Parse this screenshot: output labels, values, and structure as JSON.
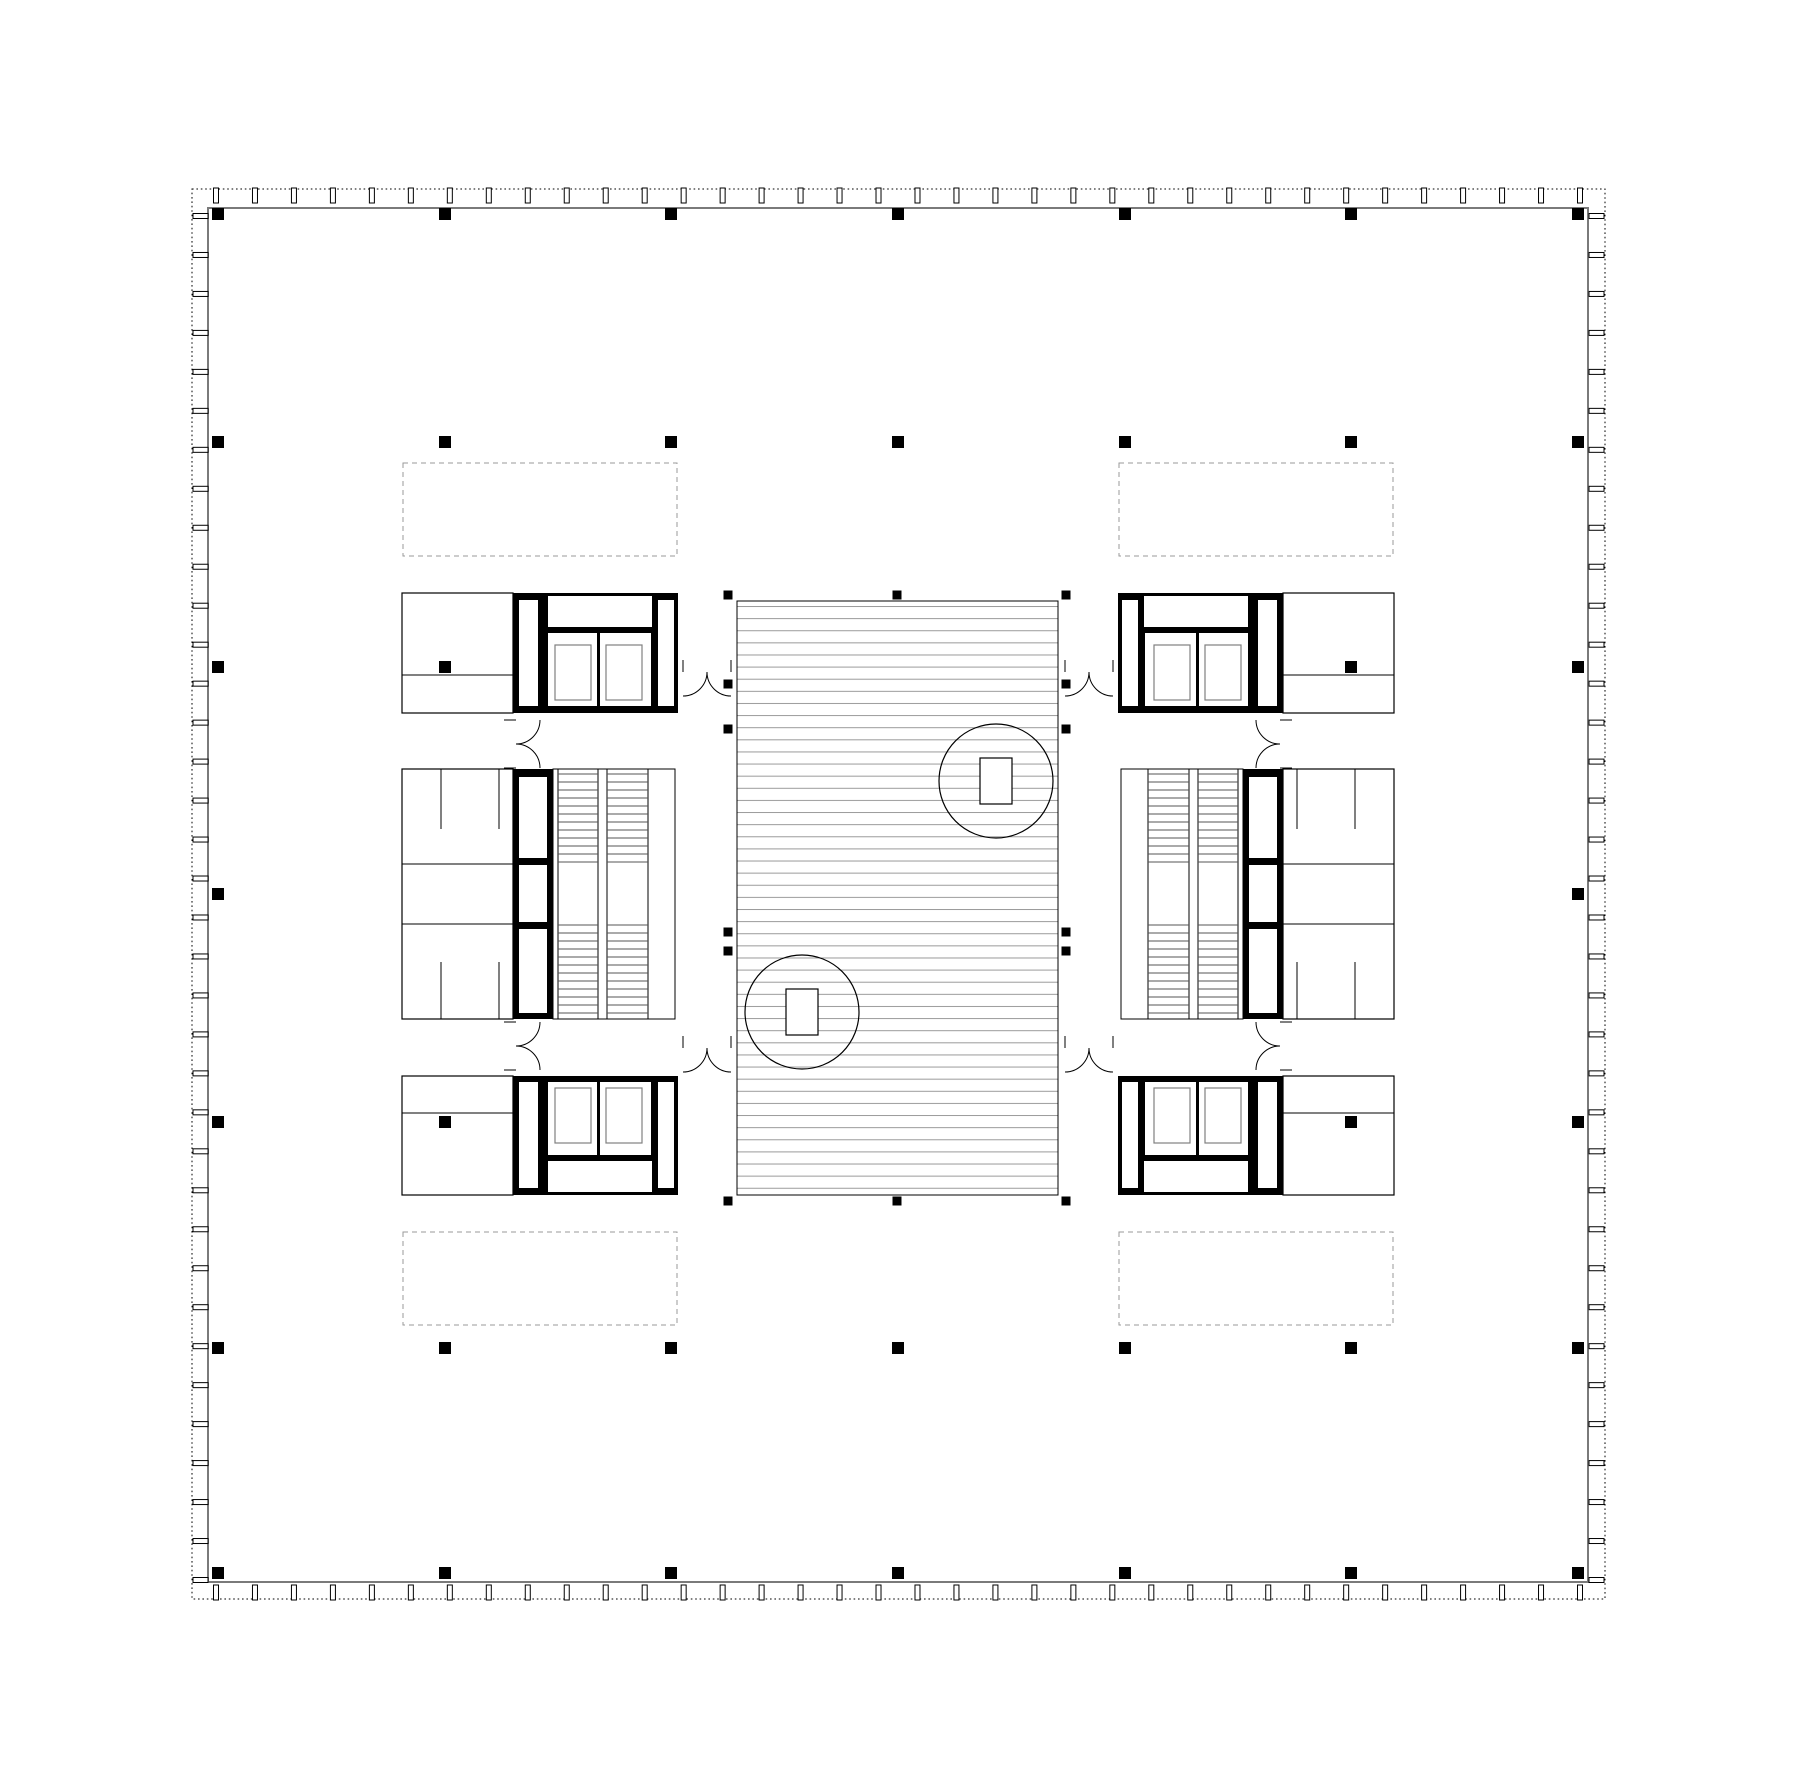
{
  "canvas": {
    "w": 1800,
    "h": 1787,
    "bg": "#ffffff"
  },
  "style": {
    "ink": "#000000",
    "slab_stroke": "#7a7a7a",
    "hatch_stroke": "#9a9a9a",
    "skylight_stroke": "#9a9a9a",
    "tread_stroke": "#555555",
    "car_stroke": "#808080",
    "room_stroke": "#000000"
  },
  "envelope": {
    "dotted_rect": [
      192,
      189,
      1413,
      1410
    ],
    "slab_rect": [
      208,
      208,
      1380,
      1374
    ],
    "mullions": {
      "count": 36,
      "start": 216,
      "end": 1580,
      "long": 15,
      "short": 5
    }
  },
  "grid": {
    "size": 12,
    "xs": [
      218,
      445,
      671,
      898,
      1125,
      1351,
      1578
    ],
    "ys": [
      214,
      442,
      667,
      894,
      1122,
      1348,
      1573
    ],
    "visible": [
      [
        0,
        0
      ],
      [
        1,
        0
      ],
      [
        2,
        0
      ],
      [
        3,
        0
      ],
      [
        4,
        0
      ],
      [
        5,
        0
      ],
      [
        6,
        0
      ],
      [
        0,
        1
      ],
      [
        1,
        1
      ],
      [
        2,
        1
      ],
      [
        3,
        1
      ],
      [
        4,
        1
      ],
      [
        5,
        1
      ],
      [
        6,
        1
      ],
      [
        0,
        2
      ],
      [
        1,
        2
      ],
      [
        5,
        2
      ],
      [
        6,
        2
      ],
      [
        0,
        3
      ],
      [
        6,
        3
      ],
      [
        0,
        4
      ],
      [
        1,
        4
      ],
      [
        5,
        4
      ],
      [
        6,
        4
      ],
      [
        0,
        5
      ],
      [
        1,
        5
      ],
      [
        2,
        5
      ],
      [
        3,
        5
      ],
      [
        4,
        5
      ],
      [
        5,
        5
      ],
      [
        6,
        5
      ],
      [
        0,
        6
      ],
      [
        1,
        6
      ],
      [
        2,
        6
      ],
      [
        3,
        6
      ],
      [
        4,
        6
      ],
      [
        5,
        6
      ],
      [
        6,
        6
      ]
    ]
  },
  "skylights": [
    [
      403,
      463,
      274,
      93
    ],
    [
      1119,
      463,
      274,
      93
    ],
    [
      403,
      1232,
      274,
      93
    ],
    [
      1119,
      1232,
      274,
      93
    ]
  ],
  "atrium": {
    "rect": [
      737,
      601,
      321,
      594
    ],
    "hatch_period": 12.12,
    "post_size": 9,
    "posts": [
      [
        728,
        595
      ],
      [
        897,
        595
      ],
      [
        1066,
        595
      ],
      [
        728,
        1201
      ],
      [
        897,
        1201
      ],
      [
        1066,
        1201
      ],
      [
        728,
        684
      ],
      [
        728,
        729
      ],
      [
        728,
        932
      ],
      [
        728,
        951
      ],
      [
        1066,
        684
      ],
      [
        1066,
        729
      ],
      [
        1066,
        932
      ],
      [
        1066,
        951
      ]
    ],
    "features": [
      {
        "circle": [
          996,
          781,
          57
        ],
        "rect": [
          980,
          758,
          32,
          46
        ]
      },
      {
        "circle": [
          802,
          1012,
          57
        ],
        "rect": [
          786,
          989,
          32,
          46
        ]
      }
    ]
  },
  "cores": {
    "rooms": [
      [
        402,
        593,
        111,
        120
      ],
      [
        402,
        769,
        111,
        250
      ],
      [
        402,
        1076,
        111,
        119
      ],
      [
        1283,
        593,
        111,
        120
      ],
      [
        1283,
        769,
        111,
        250
      ],
      [
        1283,
        1076,
        111,
        119
      ]
    ],
    "room_lines": [
      [
        402,
        675,
        513,
        675
      ],
      [
        402,
        1113,
        513,
        1113
      ],
      [
        1283,
        675,
        1394,
        675
      ],
      [
        1283,
        1113,
        1394,
        1113
      ],
      [
        402,
        864,
        513,
        864
      ],
      [
        402,
        924,
        513,
        924
      ],
      [
        1283,
        864,
        1394,
        864
      ],
      [
        1283,
        924,
        1394,
        924
      ],
      [
        441,
        769,
        441,
        829
      ],
      [
        499,
        769,
        499,
        829
      ],
      [
        441,
        962,
        441,
        1019
      ],
      [
        499,
        962,
        499,
        1019
      ],
      [
        1297,
        769,
        1297,
        829
      ],
      [
        1355,
        769,
        1355,
        829
      ],
      [
        1297,
        962,
        1297,
        1019
      ],
      [
        1355,
        962,
        1355,
        1019
      ]
    ],
    "black_walls": [
      [
        513,
        593,
        32,
        120
      ],
      [
        545,
        593,
        133,
        120
      ],
      [
        513,
        769,
        40,
        250
      ],
      [
        513,
        1076,
        32,
        119
      ],
      [
        545,
        1076,
        133,
        119
      ],
      [
        1251,
        593,
        32,
        120
      ],
      [
        1118,
        593,
        133,
        120
      ],
      [
        1243,
        769,
        40,
        250
      ],
      [
        1251,
        1076,
        32,
        119
      ],
      [
        1118,
        1076,
        133,
        119
      ]
    ],
    "white_openings": [
      [
        519,
        600,
        19,
        106
      ],
      [
        548,
        596,
        104,
        31
      ],
      [
        658,
        600,
        16,
        106
      ],
      [
        548,
        633,
        49,
        73
      ],
      [
        600,
        633,
        51,
        73
      ],
      [
        519,
        777,
        28,
        81
      ],
      [
        519,
        865,
        28,
        57
      ],
      [
        519,
        929,
        28,
        84
      ],
      [
        519,
        1082,
        19,
        106
      ],
      [
        548,
        1161,
        104,
        31
      ],
      [
        658,
        1082,
        16,
        106
      ],
      [
        548,
        1082,
        49,
        73
      ],
      [
        600,
        1082,
        51,
        73
      ],
      [
        1258,
        600,
        19,
        106
      ],
      [
        1144,
        596,
        104,
        31
      ],
      [
        1122,
        600,
        16,
        106
      ],
      [
        1199,
        633,
        49,
        73
      ],
      [
        1145,
        633,
        51,
        73
      ],
      [
        1249,
        777,
        28,
        81
      ],
      [
        1249,
        865,
        28,
        57
      ],
      [
        1249,
        929,
        28,
        84
      ],
      [
        1258,
        1082,
        19,
        106
      ],
      [
        1144,
        1161,
        104,
        31
      ],
      [
        1122,
        1082,
        16,
        106
      ],
      [
        1199,
        1082,
        49,
        73
      ],
      [
        1145,
        1082,
        51,
        73
      ]
    ],
    "elevator_cars": [
      [
        555,
        645,
        36,
        55
      ],
      [
        606,
        645,
        36,
        55
      ],
      [
        555,
        1088,
        36,
        55
      ],
      [
        606,
        1088,
        36,
        55
      ],
      [
        1205,
        645,
        36,
        55
      ],
      [
        1154,
        645,
        36,
        55
      ],
      [
        1205,
        1088,
        36,
        55
      ],
      [
        1154,
        1088,
        36,
        55
      ]
    ],
    "stair_zones": [
      [
        553,
        769,
        122,
        250
      ],
      [
        1121,
        769,
        122,
        250
      ]
    ],
    "stair_flights": [
      [
        558,
        769,
        40,
        250
      ],
      [
        607,
        769,
        41,
        250
      ],
      [
        1198,
        769,
        40,
        250
      ],
      [
        1148,
        769,
        41,
        250
      ]
    ],
    "stair_runs": [
      {
        "y0": 774,
        "y1": 862,
        "n": 12
      },
      {
        "y0": 925,
        "y1": 1013,
        "n": 12
      }
    ]
  },
  "doors": [
    {
      "cx": 707,
      "cy": 672,
      "span": 48,
      "orient": "h",
      "bulge": "down"
    },
    {
      "cx": 707,
      "cy": 1048,
      "span": 48,
      "orient": "h",
      "bulge": "down"
    },
    {
      "cx": 1089,
      "cy": 672,
      "span": 48,
      "orient": "h",
      "bulge": "down"
    },
    {
      "cx": 1089,
      "cy": 1048,
      "span": 48,
      "orient": "h",
      "bulge": "down"
    },
    {
      "cx": 516,
      "cy": 744,
      "span": 48,
      "orient": "v",
      "bulge": "right"
    },
    {
      "cx": 516,
      "cy": 1046,
      "span": 48,
      "orient": "v",
      "bulge": "right"
    },
    {
      "cx": 1280,
      "cy": 744,
      "span": 48,
      "orient": "v",
      "bulge": "left"
    },
    {
      "cx": 1280,
      "cy": 1046,
      "span": 48,
      "orient": "v",
      "bulge": "left"
    }
  ]
}
